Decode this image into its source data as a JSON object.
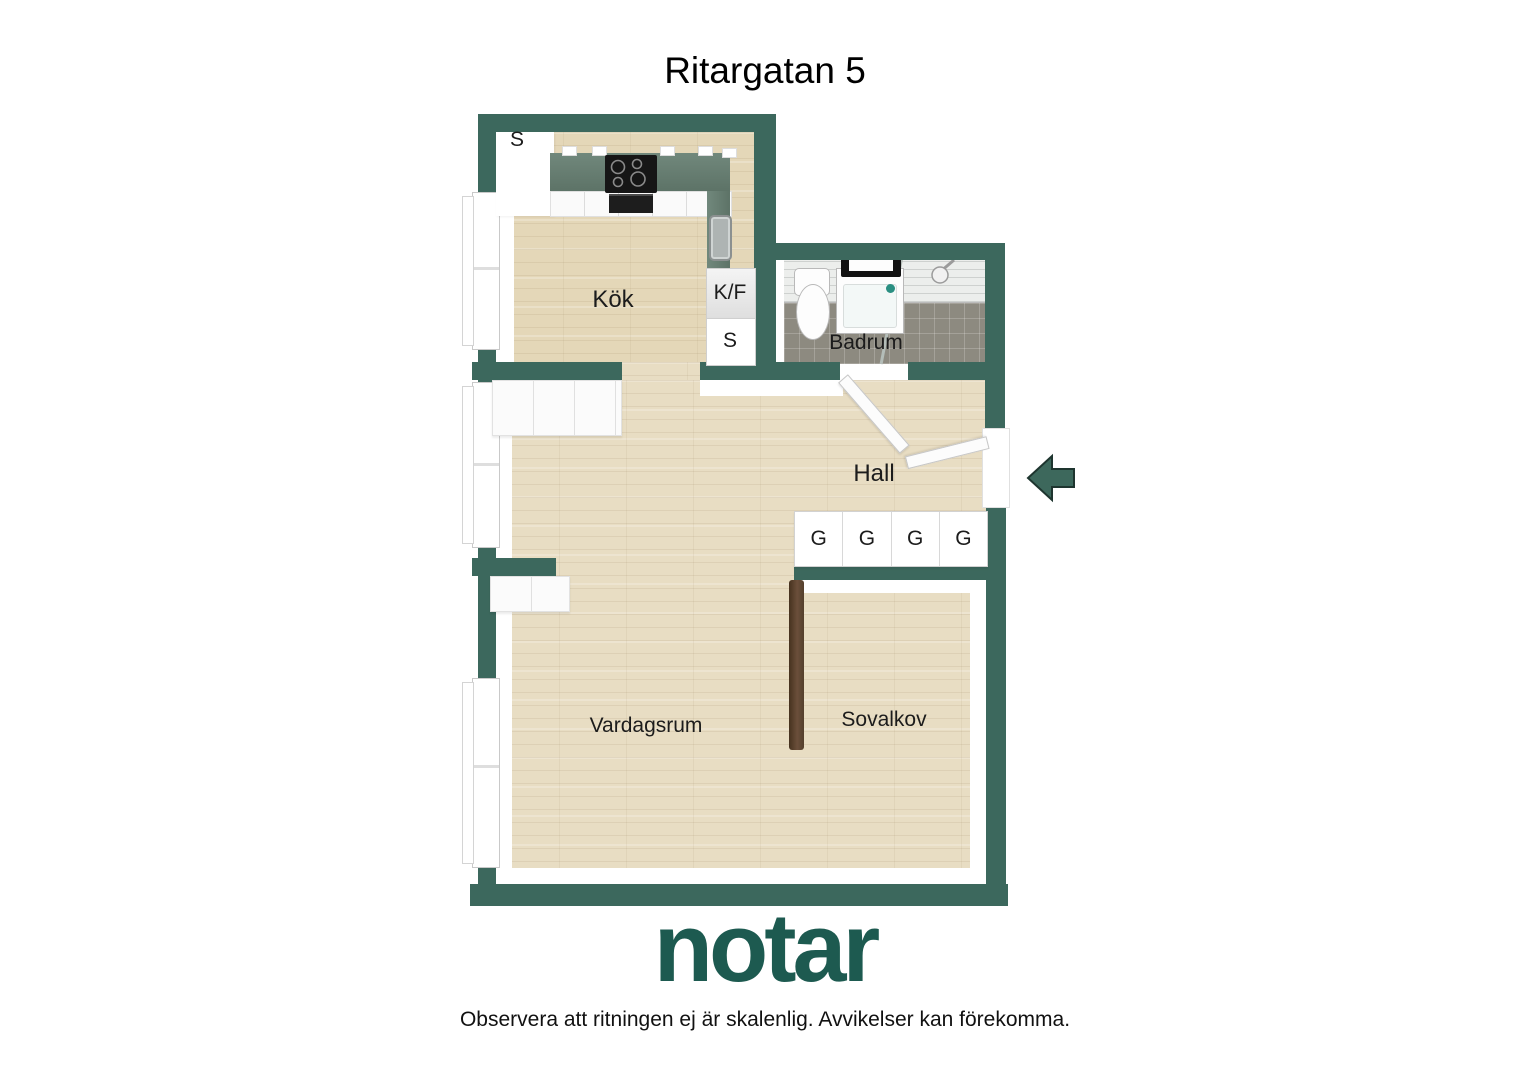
{
  "title": "Ritargatan 5",
  "plan": {
    "rooms": {
      "kitchen": "Kök",
      "bathroom": "Badrum",
      "hall": "Hall",
      "living_room": "Vardagsrum",
      "sleeping_alcove": "Sovalkov"
    },
    "closets": {
      "kitchen_top": "S",
      "fridge_freezer": "K/F",
      "kitchen_side": "S",
      "wardrobes": [
        "G",
        "G",
        "G",
        "G"
      ]
    },
    "entrance": {
      "arrow_direction": "left"
    }
  },
  "footer": {
    "logo": "notar",
    "disclaimer": "Observera att ritningen ej är skalenlig. Avvikelser kan förekomma."
  },
  "colors": {
    "wall": "#3c685d",
    "logo_green": "#1d5a50",
    "wood_floor": "#e8ddc3",
    "kitchen_counter": "#697f73",
    "bathroom_floor": "#8d8a80",
    "alcove_divider_brown": "#5a4233",
    "label_text": "#1c1c1c"
  }
}
